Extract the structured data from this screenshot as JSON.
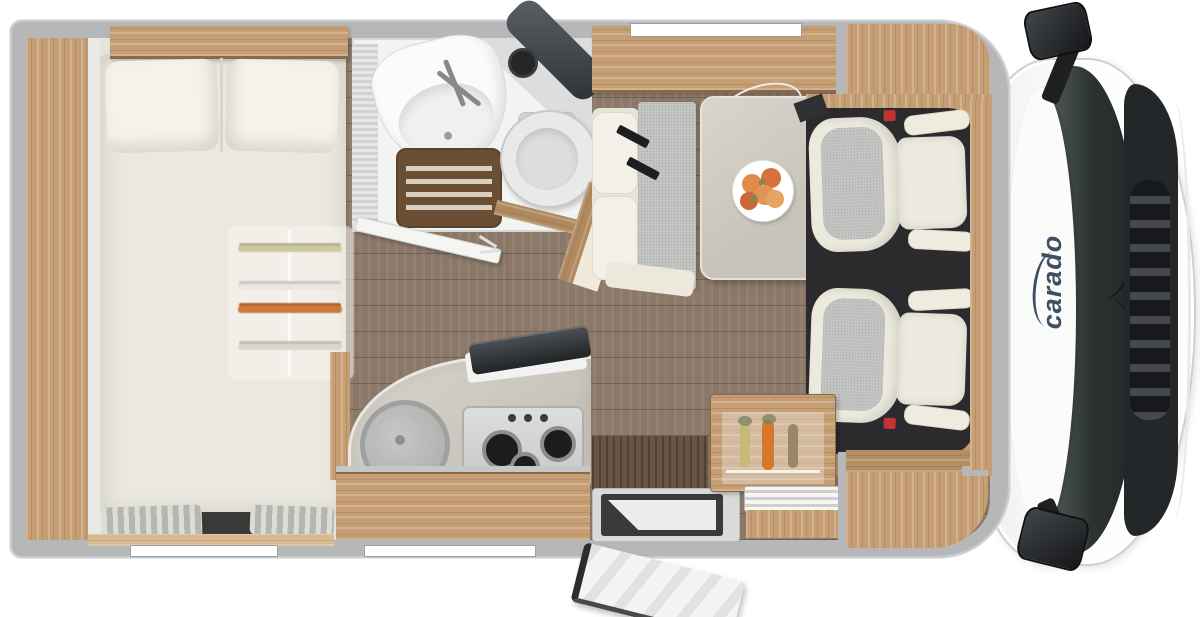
{
  "brand": {
    "logo_text": "carado"
  },
  "colors": {
    "wall_gray": "#b5b7b9",
    "wood_light": "#c59e74",
    "wood_mid": "#ab855c",
    "wood_dark": "#6a5545",
    "floor_plank": "#8b7868",
    "mattress_cream": "#ebe9df",
    "cushion_cream": "#f1efe6",
    "seat_gray": "#c6c8c6",
    "stone_gray": "#d2cfc8",
    "cab_floor_black": "#2b2b2d",
    "glass_dark": "#2c332f",
    "logo_navy": "#3d4f63",
    "fruit_orange": "#dd8445",
    "belt_red": "#c23333"
  },
  "furniture": {
    "wardrobe": "Wardrobe",
    "bed": "Bed",
    "pillow": "Pillow",
    "under_bed_storage": "Under-bed wardrobe",
    "window_curtain": "Curtain",
    "overhead_cabinet": "Overhead cabinet",
    "washroom": "Washroom",
    "sink": "Washbasin",
    "shower": "Shower tray",
    "toilet": "Toilet",
    "washroom_door": "Washroom door",
    "dinette_bench": "Dinette bench",
    "table": "Dinette table",
    "fruit_plate": "Fruit plate",
    "kitchen": "Kitchen block",
    "kitchen_sink": "Kitchen sink",
    "hob": "Gas hob",
    "fridge": "Fridge",
    "entry_step": "Entry step",
    "entry_door": "Entry door",
    "passenger_seat": "Passenger seat",
    "driver_seat": "Driver seat",
    "cab": "Driver cab",
    "windshield": "Windshield",
    "mirror": "Side mirror",
    "grille": "Front grille",
    "window": "Window"
  }
}
